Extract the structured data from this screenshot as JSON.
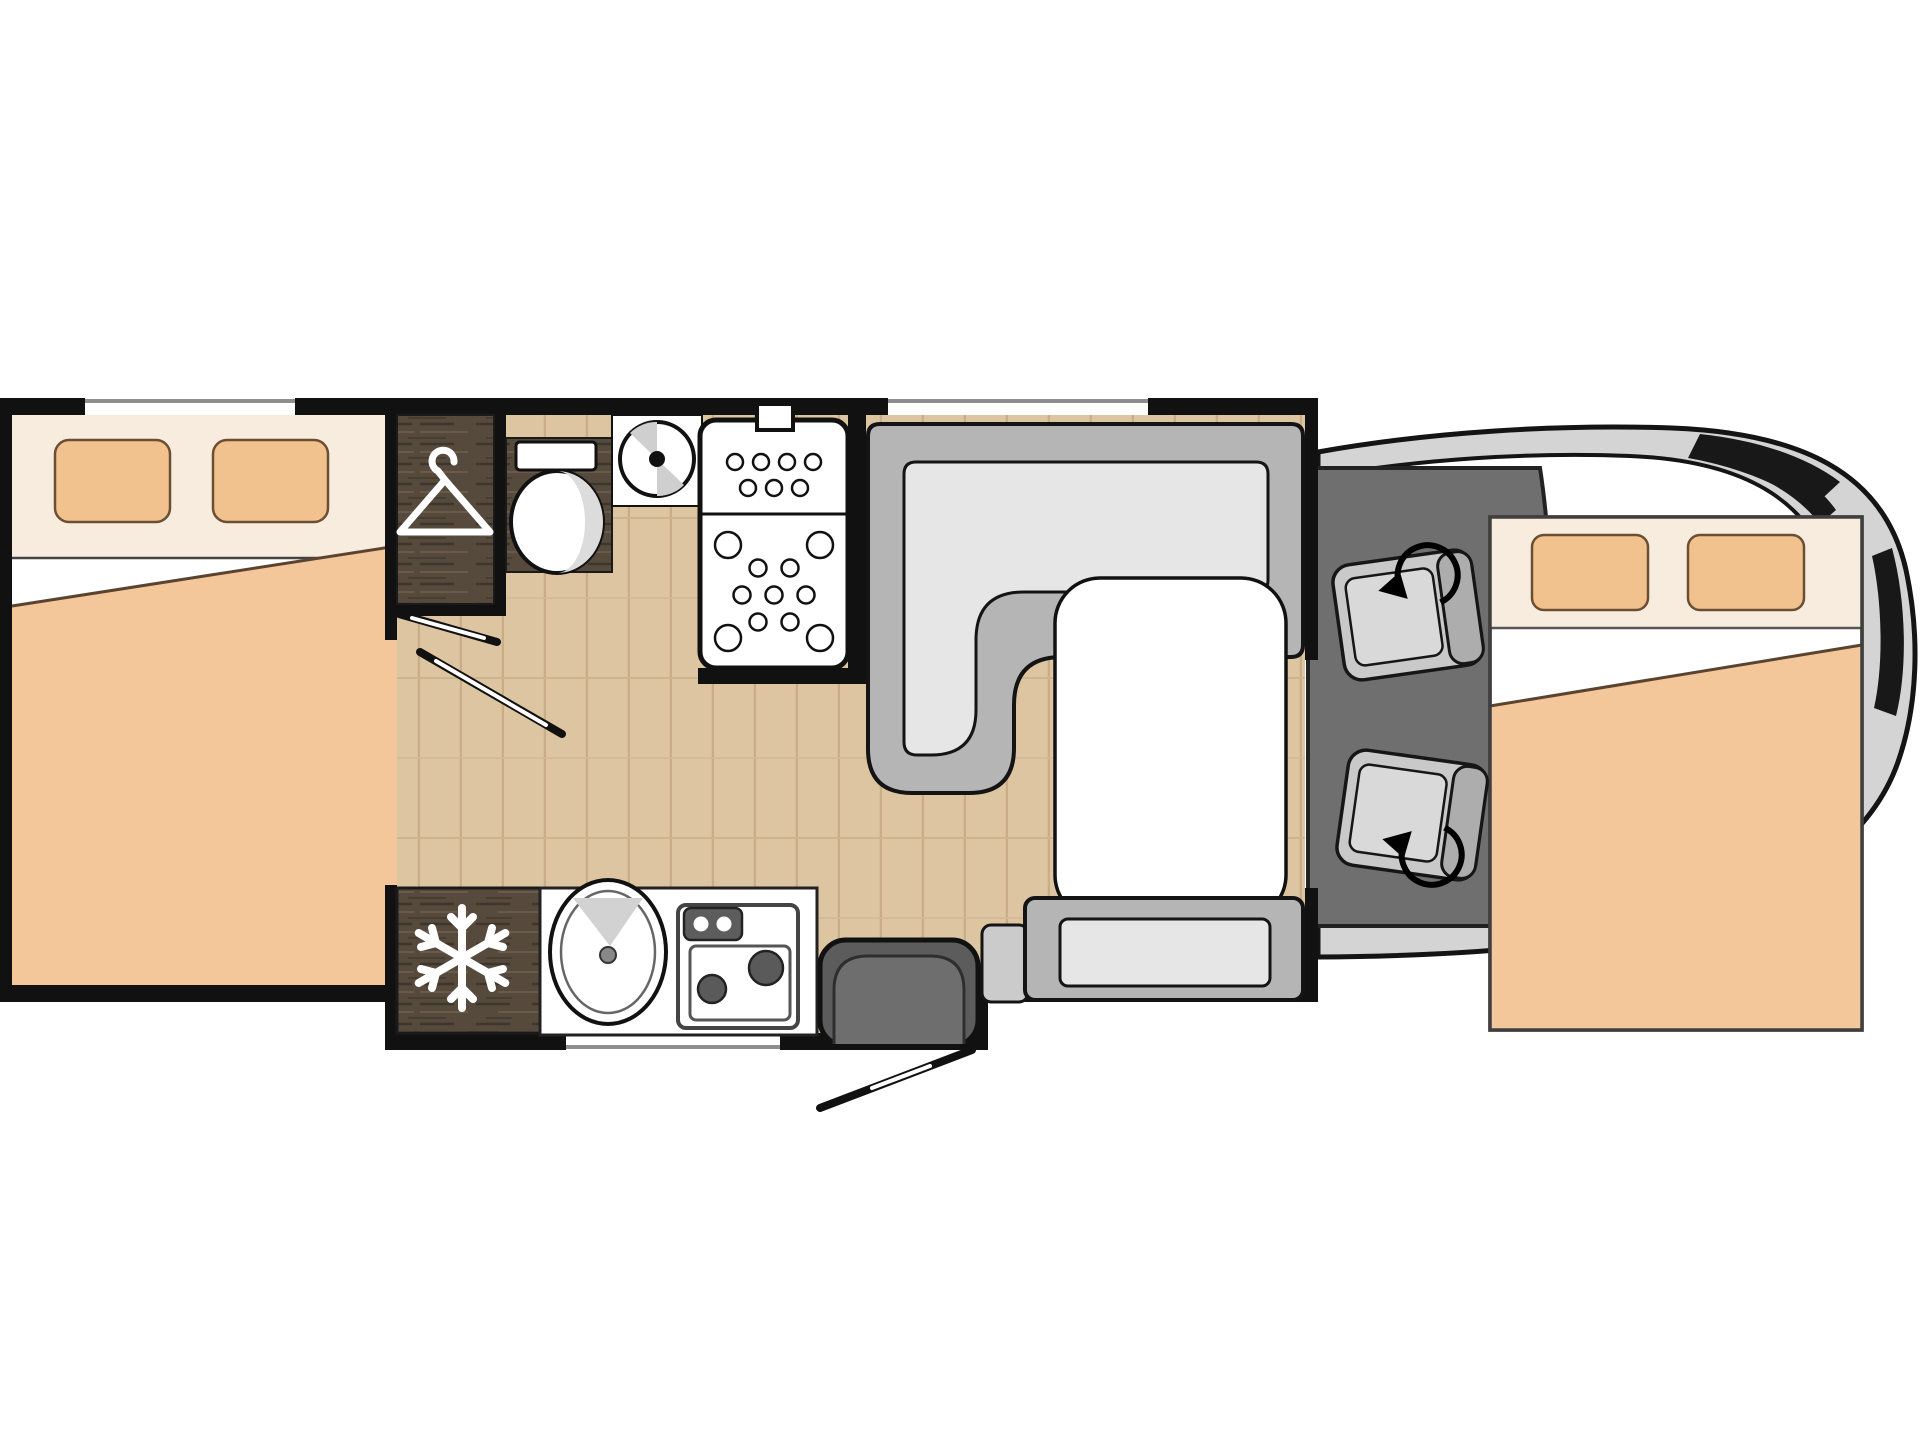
{
  "meta": {
    "type": "motorhome-floorplan",
    "view": "top-down",
    "description": "Floor plan of a coachbuilt motorhome: rear double bed, wardrobe, bathroom with toilet, basin and shower, refrigerator, kitchen block with sink and hob, entry door, L-shaped dinette with table and bench, swivel cab seats and a drop-down front double bed over the cab."
  },
  "colors": {
    "wall": "#111111",
    "floor_wood": "#dcc5a0",
    "floor_plank_line": "#c8ad86",
    "dark_wood": "#564a3d",
    "dark_wood_grain": "#3f352c",
    "bed_linen": "#f8ecdf",
    "pillow": "#f2c28e",
    "duvet": "#f4c79b",
    "pillow_outline": "#6b4f33",
    "seat_back": "#b5b5b5",
    "seat_cushion": "#e6e6e6",
    "cab_floor": "#6f6f6f",
    "vehicle_body": "#d4d4d4",
    "cab_seat": "#c9c9c9",
    "cab_seat_back": "#adadad",
    "table": "#ffffff",
    "entry_door": "#5c5c5c",
    "appliance_dark": "#5a5a5a",
    "shading_gray": "#d8d8d8"
  },
  "rooms": {
    "rear_bedroom": "Rear double bed",
    "wardrobe": "Wardrobe",
    "bathroom": "Bathroom",
    "shower": "Shower",
    "kitchen": "Kitchen",
    "dinette": "L-shaped dinette",
    "cab": "Driver cab",
    "front_bed": "Drop-down front bed"
  },
  "furniture": [
    {
      "id": "rear-bed",
      "label": "Rear double bed with two pillows and duvet"
    },
    {
      "id": "wardrobe",
      "label": "Wardrobe with hanger symbol"
    },
    {
      "id": "toilet",
      "label": "Toilet with cistern"
    },
    {
      "id": "washbasin",
      "label": "Round washbasin"
    },
    {
      "id": "shower-tray",
      "label": "Shower tray with anti-slip dots"
    },
    {
      "id": "fridge",
      "label": "Refrigerator with snowflake symbol"
    },
    {
      "id": "kitchen-sink",
      "label": "Oval kitchen sink"
    },
    {
      "id": "hob",
      "label": "Two-burner hob"
    },
    {
      "id": "entry-door",
      "label": "Entry door with swing arc"
    },
    {
      "id": "l-sofa",
      "label": "L-shaped dinette sofa"
    },
    {
      "id": "dinette-table",
      "label": "Dinette table"
    },
    {
      "id": "bench-seat",
      "label": "Forward-facing bench seat"
    },
    {
      "id": "driver-seat",
      "label": "Swivelling driver seat"
    },
    {
      "id": "passenger-seat",
      "label": "Swivelling passenger seat"
    },
    {
      "id": "front-bed",
      "label": "Drop-down double bed over cab"
    }
  ],
  "icons": [
    {
      "name": "hanger-icon",
      "meaning": "wardrobe"
    },
    {
      "name": "snowflake-icon",
      "meaning": "refrigerator"
    },
    {
      "name": "swivel-arrow-icon",
      "meaning": "rotating cab seat"
    },
    {
      "name": "door-swing-icon",
      "meaning": "door opening direction"
    }
  ]
}
